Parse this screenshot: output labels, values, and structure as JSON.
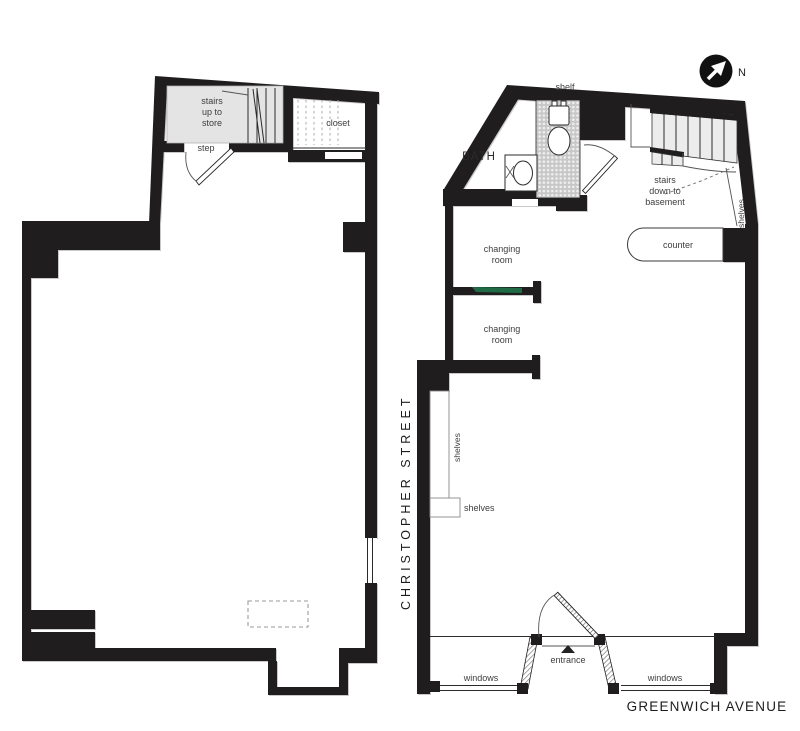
{
  "compass": {
    "north": "N"
  },
  "streets": {
    "west": "CHRISTOPHER STREET",
    "south": "GREENWICH AVENUE"
  },
  "basement": {
    "stairs_lines": [
      "stairs",
      "up to",
      "store"
    ],
    "step_label": "step",
    "closet_label": "closet"
  },
  "store": {
    "shelf_label": "shelf",
    "bath_label": "BATH",
    "stairs_lines": [
      "stairs",
      "down to",
      "basement"
    ],
    "shelves_right_label": "shelves",
    "counter_label": "counter",
    "changing1_lines": [
      "changing",
      "room"
    ],
    "changing2_lines": [
      "changing",
      "room"
    ],
    "shelves_left_vertical": "shelves",
    "shelves_left_lower": "shelves",
    "windows_left": "windows",
    "windows_right": "windows",
    "entrance_label": "entrance"
  },
  "colors": {
    "wall": "#201d1e",
    "stair_tread_fill": "#ececec",
    "stair_room_fill": "#e4e4e4",
    "tile_background": "#c7c7c7",
    "accent_green": "#1e6b45",
    "label_text": "#3d3d3d"
  }
}
